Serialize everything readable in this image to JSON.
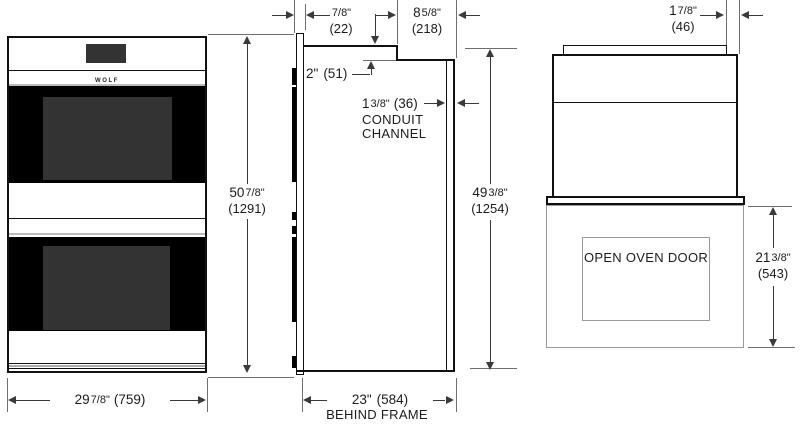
{
  "views": {
    "front": {
      "brand": "WOLF",
      "dims": {
        "width": {
          "w": "29",
          "f": "7/8\"",
          "m": "(759)"
        },
        "height": {
          "w": "50",
          "f": "7/8\"",
          "m": "(1291)"
        }
      }
    },
    "side": {
      "labels": {
        "conduit_line1": "CONDUIT",
        "conduit_line2": "CHANNEL",
        "behind_frame": "BEHIND FRAME"
      },
      "dims": {
        "frame_proud": {
          "w": "",
          "f": "7/8\"",
          "m": "(22)"
        },
        "top_rear": {
          "w": "8",
          "f": "5/8\"",
          "m": "(218)"
        },
        "step": {
          "w": "2\"",
          "f": "",
          "m": "(51)"
        },
        "conduit": {
          "w": "1",
          "f": "3/8\"",
          "m": "(36)"
        },
        "height": {
          "w": "49",
          "f": "3/8\"",
          "m": "(1254)"
        },
        "depth": {
          "w": "23\"",
          "f": "",
          "m": "(584)"
        }
      }
    },
    "open_door": {
      "labels": {
        "door": "OPEN OVEN DOOR"
      },
      "dims": {
        "top_inset": {
          "w": "1",
          "f": "7/8\"",
          "m": "(46)"
        },
        "door_depth": {
          "w": "21",
          "f": "3/8\"",
          "m": "(543)"
        }
      }
    }
  },
  "colors": {
    "object_line": "#111111",
    "dimension_line": "#3a3a3a",
    "extension_line": "#6f6f6f",
    "oven_window": "#333333",
    "door_black": "#000000",
    "open_door_outline": "#9a9a9a",
    "background": "#ffffff"
  }
}
